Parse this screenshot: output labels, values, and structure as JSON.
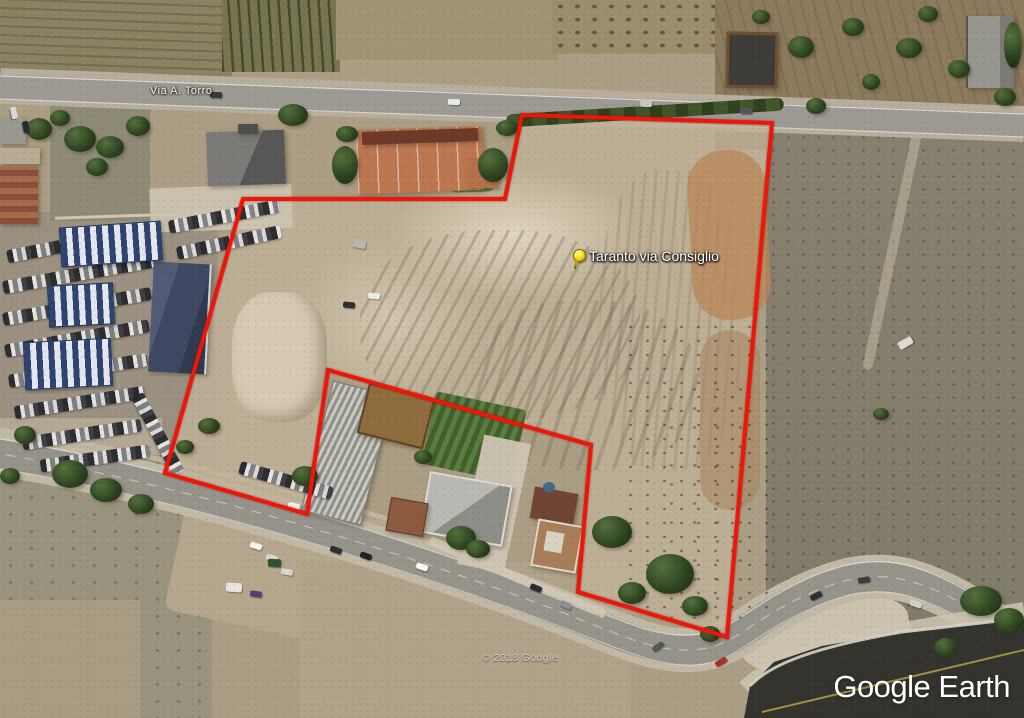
{
  "map_labels": {
    "road_label": "Via A. Torro"
  },
  "map_overlay": {
    "parcel_boundary": {
      "color": "#ee1509",
      "stroke_width": 4,
      "points": [
        [
          522,
          115
        ],
        [
          772,
          123
        ],
        [
          727,
          637
        ],
        [
          578,
          592
        ],
        [
          591,
          445
        ],
        [
          328,
          370
        ],
        [
          307,
          514
        ],
        [
          165,
          473
        ],
        [
          243,
          199
        ],
        [
          505,
          199
        ]
      ]
    },
    "pin": {
      "label": "Taranto via Consiglio",
      "x": 578,
      "y": 258,
      "color": "#ffe21f"
    }
  },
  "watermarks": {
    "copyright": "© 2018 Google",
    "logo_text": "Google Earth"
  }
}
